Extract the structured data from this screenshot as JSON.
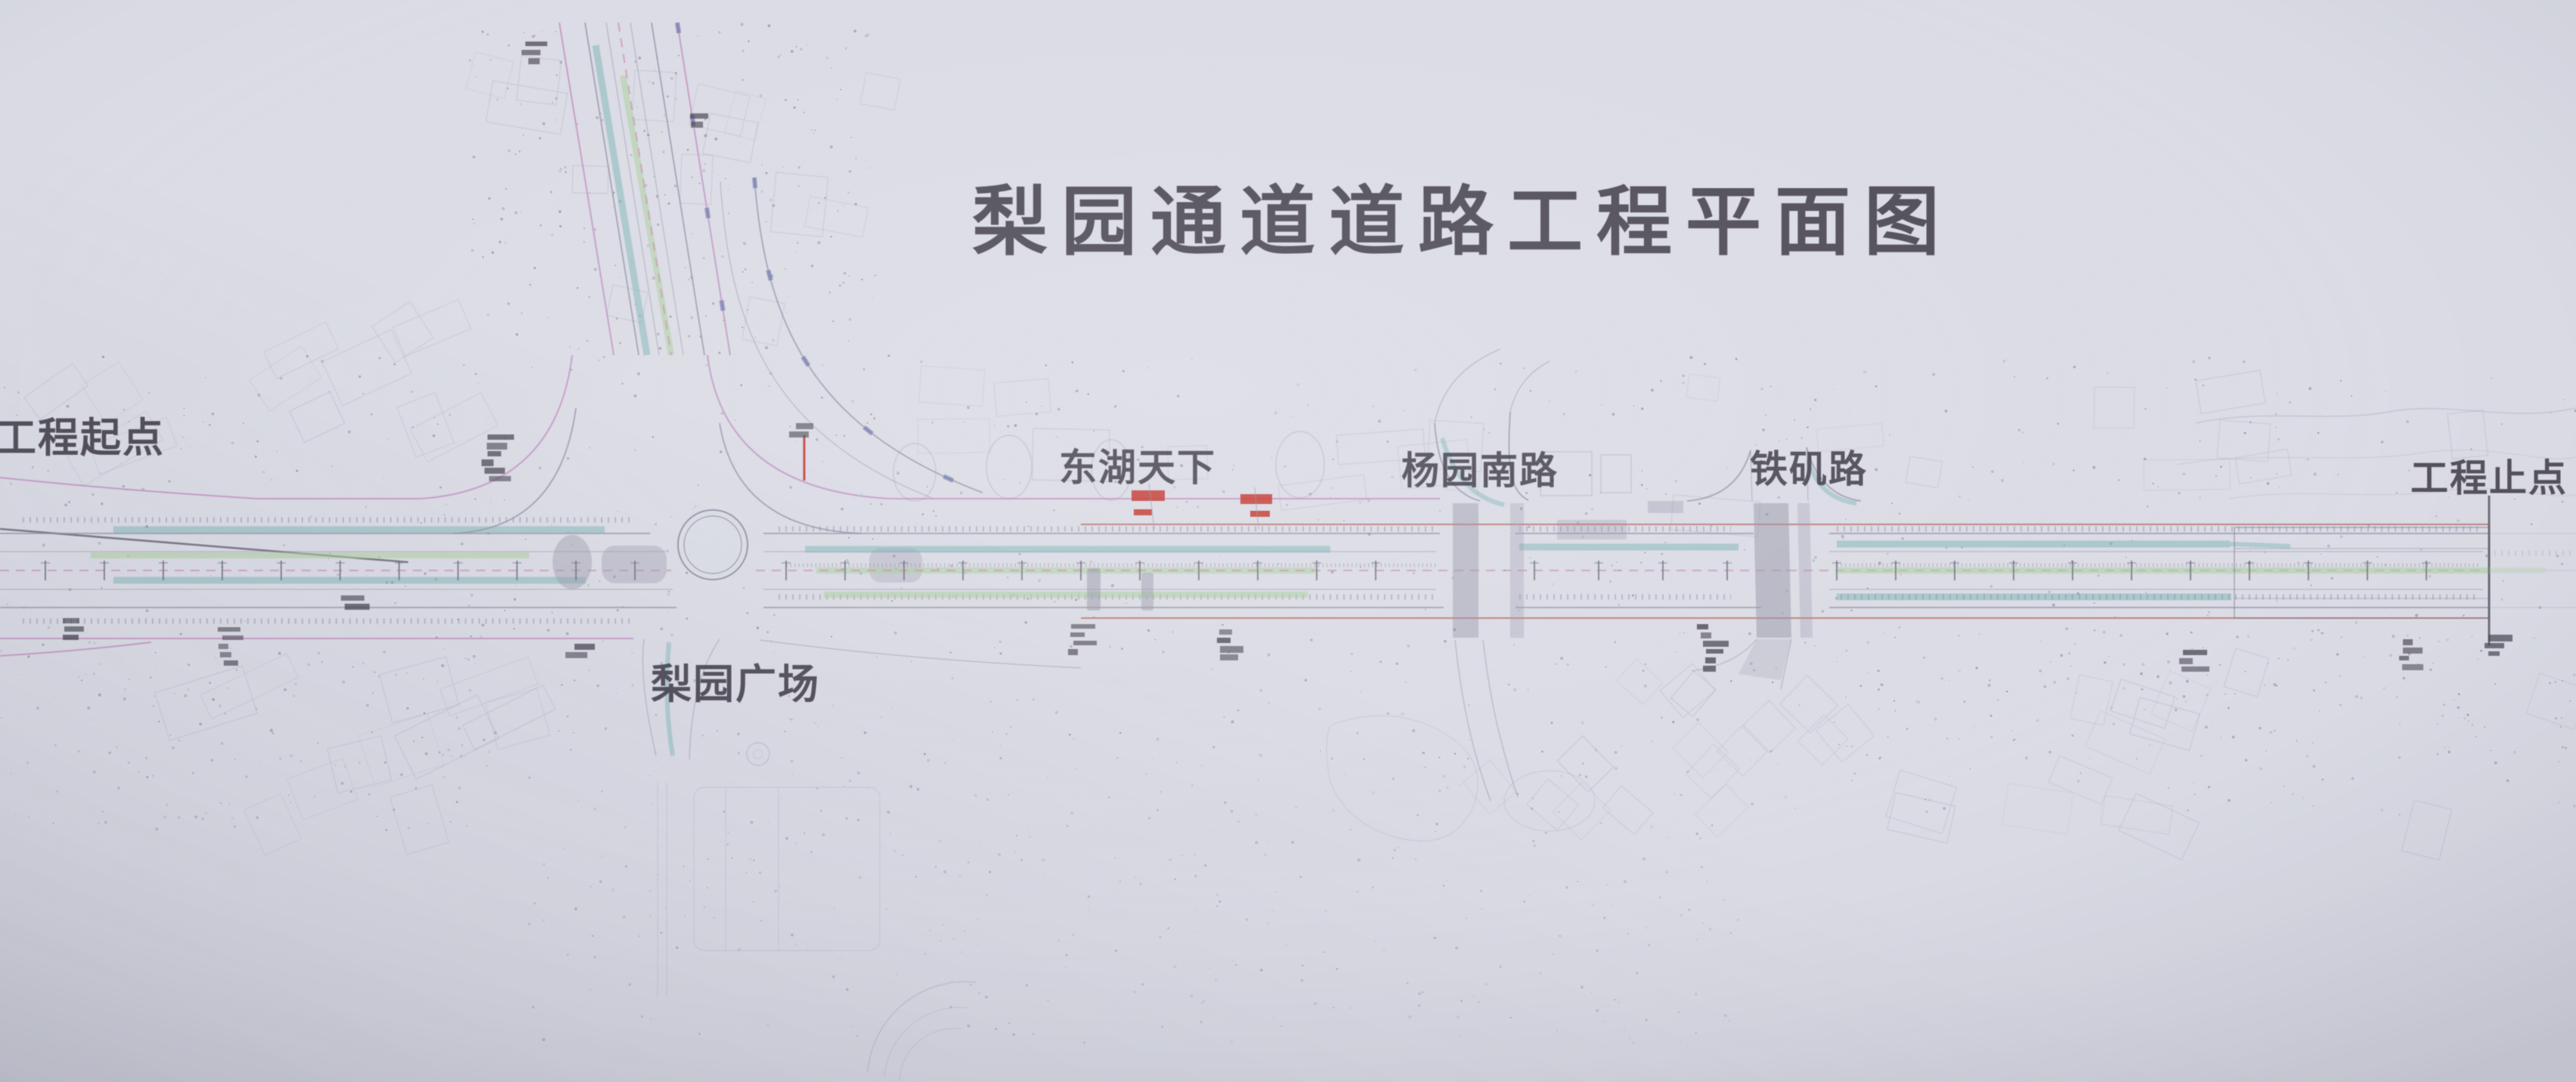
{
  "photo": {
    "kind": "photograph of road engineering plan drawing",
    "title": "梨园通道道路工程平面图",
    "annotations": {
      "project_start": "工程起点",
      "donghu_tianxia": "东湖天下",
      "yangyuan_south_road": "杨园南路",
      "tieji_road": "铁矶路",
      "project_end": "工程止点",
      "liyuan_plaza": "梨园广场"
    },
    "colors": {
      "paper": "#dcdde6",
      "ink": "#3e3c48",
      "road_line": "#918fa4",
      "teal_band": "#7db3b6",
      "green_band": "#a9cf9e",
      "magenta_line": "#bf85bf",
      "pink_dash": "#c98fb4",
      "red_mark": "#c4372f",
      "redbrown_line": "#b4655f"
    }
  }
}
